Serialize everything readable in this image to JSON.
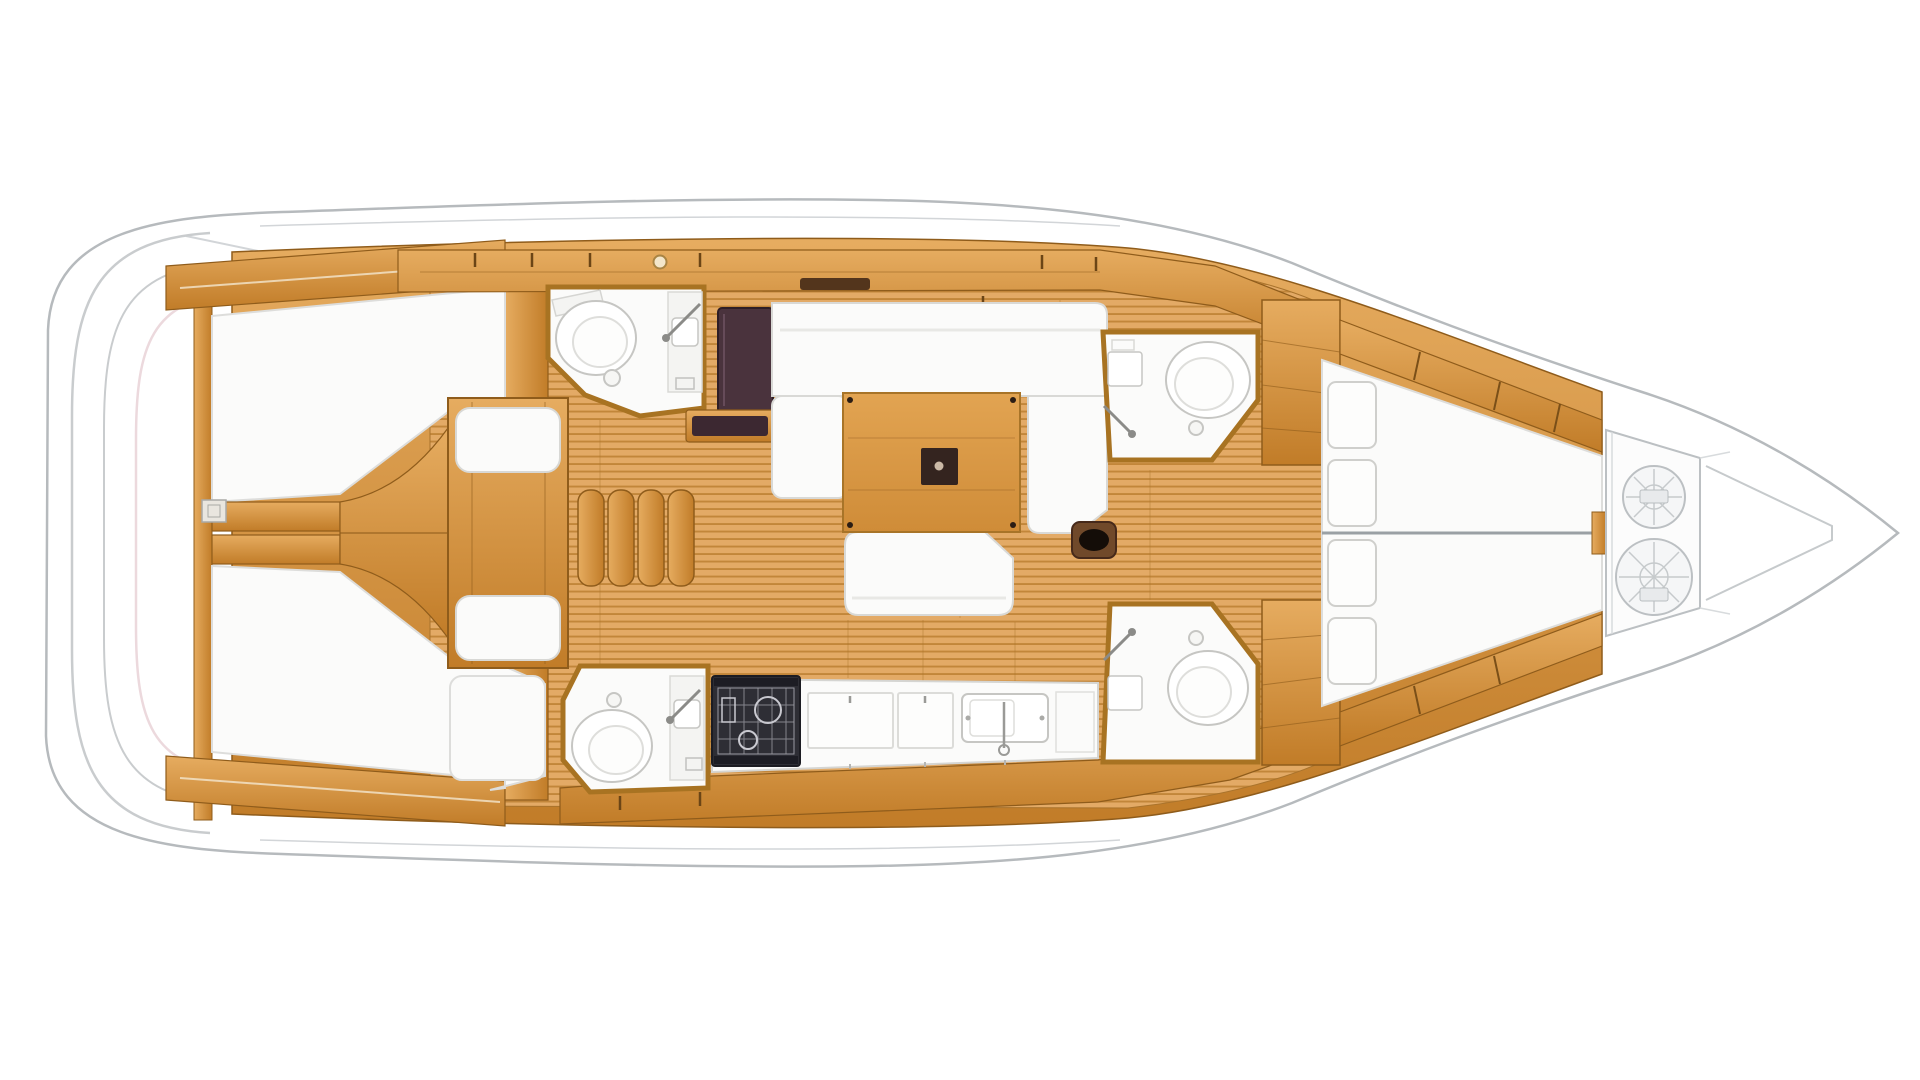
{
  "diagram": {
    "label": "Sailboat interior deck layout plan, top view, bow pointing right",
    "type": "yacht-floor-plan",
    "orientation": "bow-right",
    "rooms": [
      {
        "name": "swim-platform"
      },
      {
        "name": "aft-cabin-port-berth"
      },
      {
        "name": "aft-cabin-starboard-berth"
      },
      {
        "name": "engine-compartment-corridor"
      },
      {
        "name": "aft-head-port"
      },
      {
        "name": "aft-head-starboard"
      },
      {
        "name": "companionway-stairs"
      },
      {
        "name": "nav-station"
      },
      {
        "name": "salon-settee"
      },
      {
        "name": "salon-table"
      },
      {
        "name": "galley"
      },
      {
        "name": "forward-head-port"
      },
      {
        "name": "forward-head-starboard"
      },
      {
        "name": "forward-cabin-v-berth"
      },
      {
        "name": "anchor-locker"
      }
    ],
    "fixtures": {
      "toilets": 4,
      "showers": 4,
      "stove": 1,
      "sinks": 2,
      "rope_coils": 2,
      "berth_cushions": 4
    }
  },
  "colors": {
    "hull_fill": "#ffffff",
    "hull_stroke": "#b6babd",
    "inner_line": "#d2d5d8",
    "platform_stroke": "#c9ccce",
    "platform_pink": "#ecd9dd",
    "wood_hi": "#e6ac60",
    "wood_lo": "#c17c28",
    "wood_edge": "#8f5c1b",
    "floor_base": "#e3aa66",
    "floor_stripe": "#c2863a",
    "floor_seam": "#a9732c",
    "room_white": "#fbfbfa",
    "room_wall": "#a87322",
    "white_soft": "#f4f4f2",
    "fixture_stroke": "#c6c6c3",
    "fixture_dark": "#8b8b88",
    "dark_seat": "#4a333d",
    "dark_strip": "#3c2831",
    "dark_slot": "#53351c",
    "stove_dark": "#2e2e35",
    "stove_line": "#9a9aa2",
    "table_hi": "#e2a452",
    "table_lo": "#cf8c38",
    "table_edge": "#a87428",
    "table_dark": "#34241f",
    "rope_stroke": "#bcc0c3",
    "locker_fill": "#fcfcfc",
    "centerline": "#9aa0a4"
  }
}
